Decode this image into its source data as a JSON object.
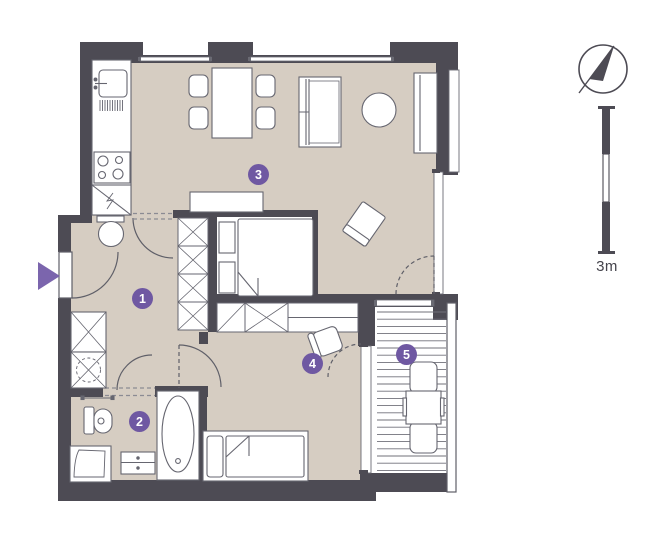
{
  "floor_plan": {
    "markers": [
      {
        "number": "1"
      },
      {
        "number": "2"
      },
      {
        "number": "3"
      },
      {
        "number": "4"
      },
      {
        "number": "5"
      }
    ],
    "colors": {
      "wall": "#4d4b54",
      "floor": "#d6cdc2",
      "accent": "#6f58a2",
      "entrance_arrow": "#7b65ad",
      "furniture_line": "#666670",
      "balcony_floor": "#ffffff"
    }
  },
  "legend": {
    "scale_label": "3m",
    "compass_icon": "compass-needle-pointing-north-east",
    "entrance_icon": "triangle-arrow-pointing-right",
    "scale_bar_segments": 3
  }
}
